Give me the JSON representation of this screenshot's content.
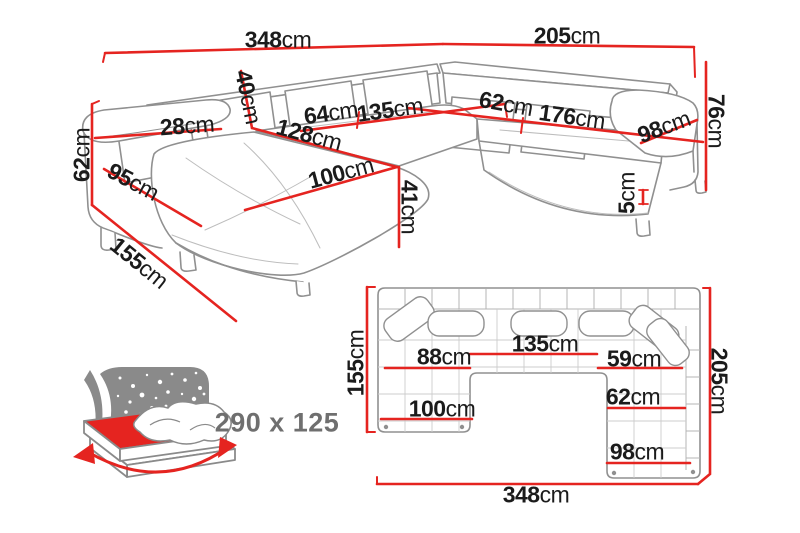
{
  "diagram_title": "corner-sofa-dimension-diagram",
  "colors": {
    "dimension_red": "#e52420",
    "outline_gray": "#909090",
    "label_black": "#1b1b1b",
    "muted_gray": "#6f6f6f"
  },
  "persp": {
    "w348": {
      "num": "348",
      "unit": "cm"
    },
    "w205": {
      "num": "205",
      "unit": "cm"
    },
    "h76": {
      "num": "76",
      "unit": "cm"
    },
    "h62": {
      "num": "62",
      "unit": "cm"
    },
    "w28": {
      "num": "28",
      "unit": "cm"
    },
    "h40": {
      "num": "40",
      "unit": "cm"
    },
    "s64": {
      "num": "64",
      "unit": "cm"
    },
    "s135": {
      "num": "135",
      "unit": "cm"
    },
    "s62": {
      "num": "62",
      "unit": "cm"
    },
    "s176": {
      "num": "176",
      "unit": "cm"
    },
    "s98": {
      "num": "98",
      "unit": "cm"
    },
    "s128": {
      "num": "128",
      "unit": "cm"
    },
    "s100": {
      "num": "100",
      "unit": "cm"
    },
    "h41": {
      "num": "41",
      "unit": "cm"
    },
    "d95": {
      "num": "95",
      "unit": "cm"
    },
    "d155": {
      "num": "155",
      "unit": "cm"
    },
    "h5": {
      "num": "5",
      "unit": "cm"
    }
  },
  "plan": {
    "d155": {
      "num": "155",
      "unit": "cm"
    },
    "d205": {
      "num": "205",
      "unit": "cm"
    },
    "w348": {
      "num": "348",
      "unit": "cm"
    },
    "s88": {
      "num": "88",
      "unit": "cm"
    },
    "s135": {
      "num": "135",
      "unit": "cm"
    },
    "s59": {
      "num": "59",
      "unit": "cm"
    },
    "s62": {
      "num": "62",
      "unit": "cm"
    },
    "s100": {
      "num": "100",
      "unit": "cm"
    },
    "s98": {
      "num": "98",
      "unit": "cm"
    }
  },
  "sleep": {
    "size": "290 x 125"
  }
}
